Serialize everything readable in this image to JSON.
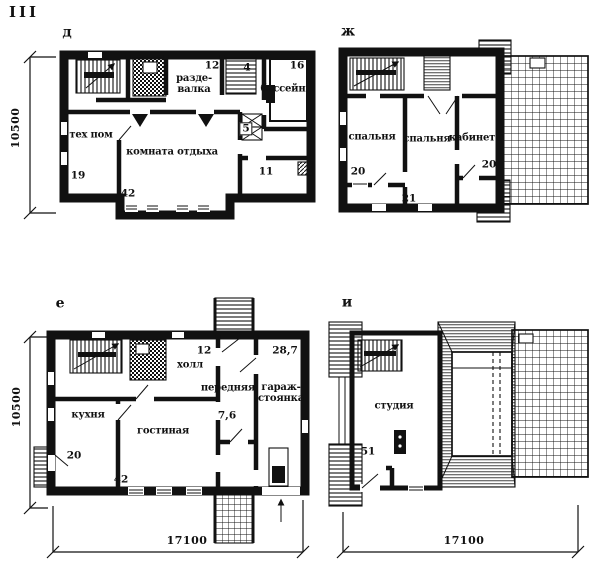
{
  "sheet": {
    "title": "III"
  },
  "dimensions": {
    "left_top": "10500",
    "left_bottom": "10500",
    "bottom_left": "17100",
    "bottom_right": "17100"
  },
  "colors": {
    "ink": "#111111",
    "paper": "#ffffff"
  },
  "plans": {
    "d": {
      "letter": "д",
      "rooms": {
        "razdevalka": {
          "label": "разде-\nвалка",
          "number": "12"
        },
        "stair": {
          "number": "4"
        },
        "bassein": {
          "label": "бассейн",
          "number": "16"
        },
        "tekhpom": {
          "label": "тех пом",
          "number": "19"
        },
        "komnata": {
          "label": "комната отдыха",
          "number": "42"
        },
        "shaft": {
          "number": "5"
        },
        "room11": {
          "number": "11"
        }
      }
    },
    "zh": {
      "letter": "ж",
      "rooms": {
        "spalnya1": {
          "label": "спальня",
          "number": "20"
        },
        "spalnya2": {
          "label": "спальня",
          "number": "21"
        },
        "kabinet": {
          "label": "кабинет",
          "number": "20"
        }
      }
    },
    "e": {
      "letter": "е",
      "rooms": {
        "kholl": {
          "label": "холл",
          "number": "12"
        },
        "perednyaya": {
          "label": "передняя"
        },
        "vestibule": {
          "number": "7,6"
        },
        "garazh": {
          "label": "гараж-\nстоянка",
          "number": "28,7"
        },
        "kukhnya": {
          "label": "кухня",
          "number": "20"
        },
        "gostinaya": {
          "label": "гостиная",
          "number": "42"
        }
      }
    },
    "i": {
      "letter": "и",
      "rooms": {
        "studiya": {
          "label": "студия",
          "number": "51"
        }
      }
    }
  }
}
